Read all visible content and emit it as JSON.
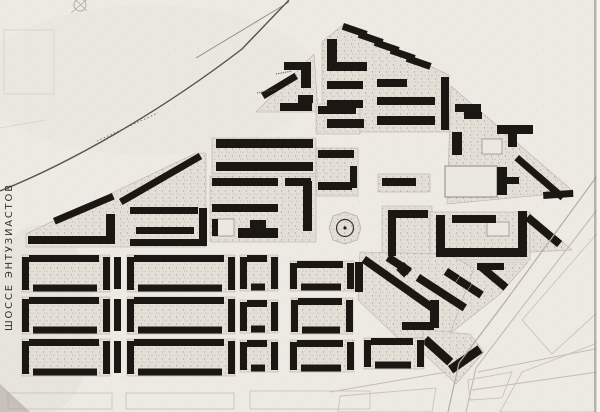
{
  "canvas": {
    "w": 600,
    "h": 412
  },
  "palette": {
    "paper": "#edeae4",
    "ink": "#1b1712",
    "court_stroke": "#b9b3a8",
    "faint": "#c9c3b8",
    "rail": "#46413b",
    "pale_building": "#ebe8e1",
    "label_ink": "#37322b"
  },
  "labels": {
    "left_road": "ШОССЕ  ЭНТУЗИАСТОВ"
  },
  "map": {
    "type": "scanned-urban-plan",
    "features": [
      {
        "t": "ellipse",
        "name": "paper-tone-wash",
        "cx": 150,
        "cy": 80,
        "rx": 170,
        "ry": 75,
        "f": "#e7e3dc",
        "o": 0.55
      },
      {
        "t": "ellipse",
        "name": "paper-tone-wash",
        "cx": 40,
        "cy": 320,
        "rx": 55,
        "ry": 95,
        "f": "#e2ded6",
        "o": 0.5
      },
      {
        "t": "rect",
        "name": "paper-grain-overlay",
        "x": 0,
        "y": 0,
        "w": 600,
        "h": 412,
        "f": "grain",
        "o": 0.6
      },
      {
        "t": "rects",
        "name": "faint-survey-outline",
        "s": "#d7d3ca",
        "items": [
          [
            4,
            30,
            50,
            64
          ]
        ]
      },
      {
        "t": "path",
        "name": "faint-survey-line",
        "d": "M0,128 L46,120",
        "s": "#d7d3ca",
        "w": 0.8
      },
      {
        "t": "path",
        "name": "railway-curve",
        "d": "M0,191 C70,163 160,112 242,49 L289,0",
        "s": "@rail",
        "w": 1.4,
        "o": 0.9
      },
      {
        "t": "path",
        "name": "railway-branch-line",
        "d": "M196,58 L289,2",
        "s": "#6f6961",
        "w": 0.9,
        "o": 0.75
      },
      {
        "t": "path",
        "name": "railway-caption-marks",
        "d": "M97,141 L158,113",
        "s": "#716b62",
        "w": 1.1,
        "o": 0.8,
        "dash": "1.5,2.2"
      },
      {
        "t": "circle",
        "name": "survey-mark-circle",
        "cx": 80,
        "cy": 5,
        "r": 6,
        "s": "#b3ada2",
        "w": 1
      },
      {
        "t": "path",
        "name": "survey-mark-lines",
        "d": "M71,13 L90,-3 M87,11 L74,-2",
        "s": "#b3ada2",
        "w": 0.8
      },
      {
        "t": "poly",
        "name": "block-wedge-courtyard",
        "pts": "26,247 26,234 196,153 206,153 206,247",
        "f": "speckle",
        "s": "@court_stroke",
        "sw": 0.6
      },
      {
        "t": "poly",
        "name": "block-hook-courtyard",
        "pts": "256,112 314,54 318,112",
        "f": "speckle",
        "s": "@court_stroke",
        "sw": 0.6
      },
      {
        "t": "poly",
        "name": "block-pentagon-courtyard",
        "pts": "322,42 344,24 430,66 449,75 449,132 322,132",
        "f": "speckle",
        "s": "@court_stroke",
        "sw": 0.6
      },
      {
        "t": "rect",
        "name": "block-center-north-courtyard",
        "x": 212,
        "y": 138,
        "w": 104,
        "h": 36,
        "f": "speckle",
        "s": "@court_stroke",
        "sw": 0.6
      },
      {
        "t": "rect",
        "name": "block-center-south-courtyard",
        "x": 210,
        "y": 176,
        "w": 106,
        "h": 66,
        "f": "speckle",
        "s": "@court_stroke",
        "sw": 0.6
      },
      {
        "t": "rect",
        "name": "block-midcol-north-courtyard",
        "x": 316,
        "y": 104,
        "w": 44,
        "h": 30,
        "f": "speckle",
        "s": "@court_stroke",
        "sw": 0.6
      },
      {
        "t": "rect",
        "name": "block-midcol-south-courtyard",
        "x": 316,
        "y": 148,
        "w": 42,
        "h": 48,
        "f": "speckle",
        "s": "@court_stroke",
        "sw": 0.6
      },
      {
        "t": "rect",
        "name": "block-east-plaza-north-courtyard",
        "x": 378,
        "y": 174,
        "w": 52,
        "h": 18,
        "f": "speckle",
        "s": "@court_stroke",
        "sw": 0.6
      },
      {
        "t": "rect",
        "name": "block-east-plaza-courtyard",
        "x": 382,
        "y": 206,
        "w": 50,
        "h": 50,
        "f": "speckle",
        "s": "@court_stroke",
        "sw": 0.6
      },
      {
        "t": "poly",
        "name": "block-northeast-triangle-courtyard",
        "pts": "451,86 574,192 447,204",
        "f": "speckle",
        "s": "@court_stroke",
        "sw": 0.6
      },
      {
        "t": "rect",
        "name": "block-east-court-courtyard",
        "x": 430,
        "y": 212,
        "w": 100,
        "h": 48,
        "f": "speckle",
        "s": "@court_stroke",
        "sw": 0.6
      },
      {
        "t": "poly",
        "name": "block-east-court-wing-courtyard",
        "pts": "530,214 572,250 530,252",
        "f": "speckle",
        "s": "@court_stroke",
        "sw": 0.6
      },
      {
        "t": "poly",
        "name": "block-diagonal-rows-courtyard",
        "pts": "416,262 528,262 500,294 452,332 416,324",
        "f": "speckle",
        "s": "@court_stroke",
        "sw": 0.6
      },
      {
        "t": "poly",
        "name": "block-diagonal-wedge-courtyard",
        "pts": "360,252 448,254 474,268 450,334 400,340 358,300",
        "f": "speckle",
        "s": "@court_stroke",
        "sw": 0.6
      },
      {
        "t": "poly",
        "name": "block-chevron-courtyard",
        "pts": "424,330 470,334 484,352 456,384 420,350",
        "f": "speckle",
        "s": "@court_stroke",
        "sw": 0.6
      },
      {
        "t": "poly",
        "name": "plaza-park",
        "pts": "345,212 357,216 361,228 357,240 345,244 333,240 329,228 333,216",
        "f": "speckle",
        "s": "#b0aa9f",
        "sw": 0.7
      },
      {
        "t": "circle",
        "name": "plaza-ring",
        "cx": 345,
        "cy": 228,
        "r": 8.5,
        "s": "#38332d",
        "w": 1.2
      },
      {
        "t": "circle",
        "name": "plaza-center-dot",
        "cx": 345,
        "cy": 228,
        "r": 1.6,
        "f": "#241f1a"
      },
      {
        "t": "rect",
        "name": "pale-hall-building",
        "x": 445,
        "y": 166,
        "w": 52,
        "h": 31,
        "f": "@pale_building",
        "s": "#8f897e",
        "sw": 1
      },
      {
        "t": "rect",
        "name": "pale-building",
        "x": 482,
        "y": 139,
        "w": 20,
        "h": 15,
        "f": "@pale_building",
        "s": "#9a948a",
        "sw": 0.8
      },
      {
        "t": "rect",
        "name": "pale-building",
        "x": 487,
        "y": 222,
        "w": 22,
        "h": 14,
        "f": "@pale_building",
        "s": "#9a948a",
        "sw": 0.8
      },
      {
        "t": "rect",
        "name": "pale-building",
        "x": 214,
        "y": 219,
        "w": 20,
        "h": 17,
        "f": "@pale_building",
        "s": "#9a948a",
        "sw": 0.8
      },
      {
        "t": "bars",
        "name": "wedge-building",
        "items": [
          [
            53,
            218,
            64,
            7,
            -23
          ],
          [
            119,
            199,
            92,
            7,
            -30
          ],
          [
            28,
            236,
            86,
            8
          ],
          [
            106,
            214,
            9,
            30
          ],
          [
            130,
            207,
            68,
            7
          ],
          [
            136,
            227,
            58,
            7
          ],
          [
            130,
            239,
            74,
            7
          ],
          [
            199,
            208,
            8,
            38
          ]
        ]
      },
      {
        "t": "bars",
        "name": "hook-building",
        "items": [
          [
            261,
            93,
            39,
            7,
            -31
          ],
          [
            284,
            62,
            26,
            8
          ],
          [
            301,
            62,
            10,
            26
          ],
          [
            298,
            95,
            15,
            8
          ],
          [
            280,
            103,
            32,
            8
          ]
        ]
      },
      {
        "t": "path",
        "name": "tiny-annotation-marks",
        "d": "M276,74 L292,71 M257,93 L277,89",
        "s": "#4e4943",
        "w": 1.1,
        "dash": "1.2,1.1",
        "o": 0.9
      },
      {
        "t": "bars",
        "name": "pentagon-building",
        "items": [
          [
            344,
            23,
            25,
            7,
            19
          ],
          [
            360,
            31,
            25,
            7,
            19
          ],
          [
            376,
            39,
            25,
            7,
            19
          ],
          [
            392,
            47,
            25,
            7,
            19
          ],
          [
            408,
            55,
            25,
            7,
            19
          ],
          [
            327,
            39,
            10,
            29
          ],
          [
            327,
            62,
            40,
            9
          ],
          [
            327,
            81,
            36,
            8
          ],
          [
            377,
            79,
            30,
            8
          ],
          [
            327,
            100,
            36,
            8
          ],
          [
            377,
            97,
            58,
            8
          ],
          [
            327,
            119,
            37,
            9
          ],
          [
            377,
            116,
            58,
            9
          ],
          [
            441,
            77,
            8,
            53
          ]
        ]
      },
      {
        "t": "bars",
        "name": "center-north-building",
        "items": [
          [
            216,
            139,
            97,
            9
          ],
          [
            216,
            162,
            97,
            9
          ]
        ]
      },
      {
        "t": "bars",
        "name": "center-south-building",
        "items": [
          [
            212,
            178,
            66,
            8
          ],
          [
            212,
            204,
            66,
            8
          ],
          [
            285,
            178,
            26,
            8
          ],
          [
            303,
            181,
            9,
            50
          ],
          [
            238,
            228,
            40,
            10
          ],
          [
            250,
            220,
            16,
            9
          ],
          [
            212,
            219,
            6,
            17
          ]
        ]
      },
      {
        "t": "bars",
        "name": "midcol-building",
        "items": [
          [
            318,
            106,
            38,
            8
          ],
          [
            318,
            150,
            36,
            8
          ],
          [
            318,
            182,
            34,
            8
          ],
          [
            350,
            166,
            7,
            22
          ]
        ]
      },
      {
        "t": "bars",
        "name": "east-plaza-building",
        "items": [
          [
            382,
            178,
            34,
            8
          ],
          [
            388,
            210,
            8,
            46
          ],
          [
            388,
            210,
            40,
            8
          ],
          [
            390,
            254,
            26,
            8,
            33
          ],
          [
            404,
            262,
            11,
            11,
            45
          ]
        ]
      },
      {
        "t": "bars",
        "name": "triangle-building",
        "items": [
          [
            455,
            104,
            26,
            8
          ],
          [
            464,
            112,
            18,
            7
          ],
          [
            452,
            132,
            10,
            23
          ],
          [
            497,
            125,
            36,
            9
          ],
          [
            508,
            134,
            9,
            13
          ],
          [
            497,
            167,
            10,
            28
          ],
          [
            506,
            177,
            13,
            7
          ],
          [
            519,
            155,
            32,
            7,
            41
          ],
          [
            541,
            174,
            32,
            7,
            41
          ],
          [
            543,
            192,
            30,
            7,
            -4
          ]
        ]
      },
      {
        "t": "bars",
        "name": "east-court-building",
        "items": [
          [
            436,
            215,
            9,
            42
          ],
          [
            436,
            248,
            90,
            9
          ],
          [
            518,
            211,
            9,
            46
          ],
          [
            452,
            215,
            44,
            8
          ],
          [
            530,
            214,
            42,
            8,
            40
          ]
        ]
      },
      {
        "t": "bars",
        "name": "diagonal-row-building",
        "items": [
          [
            420,
            274,
            56,
            8,
            33
          ],
          [
            448,
            268,
            14,
            8,
            33
          ],
          [
            460,
            276,
            14,
            8,
            33
          ],
          [
            472,
            284,
            14,
            8,
            33
          ],
          [
            477,
            263,
            27,
            7
          ],
          [
            484,
            264,
            32,
            8,
            40
          ]
        ]
      },
      {
        "t": "bars",
        "name": "diagonal-wedge-building",
        "items": [
          [
            355,
            262,
            8,
            30
          ],
          [
            366,
            256,
            30,
            8,
            35
          ],
          [
            390,
            273,
            30,
            8,
            35
          ],
          [
            414,
            290,
            30,
            8,
            35
          ],
          [
            430,
            300,
            9,
            28
          ],
          [
            402,
            322,
            32,
            8
          ],
          [
            428,
            336,
            34,
            9,
            42
          ],
          [
            448,
            366,
            36,
            9,
            -35
          ]
        ]
      },
      {
        "t": "cells",
        "name": "residential-block",
        "items": [
          [
            22,
            255,
            88,
            37
          ],
          [
            127,
            255,
            108,
            37
          ],
          [
            240,
            255,
            38,
            36
          ],
          [
            290,
            261,
            64,
            30
          ],
          [
            22,
            297,
            88,
            37
          ],
          [
            127,
            297,
            108,
            37
          ],
          [
            240,
            300,
            38,
            33
          ],
          [
            291,
            298,
            62,
            36
          ],
          [
            22,
            339,
            88,
            37
          ],
          [
            127,
            339,
            108,
            37
          ],
          [
            240,
            340,
            38,
            32
          ],
          [
            290,
            340,
            64,
            32
          ],
          [
            364,
            338,
            60,
            31
          ]
        ]
      },
      {
        "t": "bars",
        "name": "inter-block-building",
        "items": [
          [
            114,
            257,
            7,
            32
          ],
          [
            114,
            299,
            7,
            32
          ],
          [
            114,
            341,
            7,
            32
          ]
        ]
      },
      {
        "t": "path",
        "name": "avenue-edge-line",
        "d": "M597,176 L505,302 L459,363 L448,412",
        "s": "#b4aea3",
        "w": 1.2
      },
      {
        "t": "path",
        "name": "avenue-edge-line",
        "d": "M600,206 L520,310 L476,368 L466,412",
        "s": "#bdb7ac",
        "w": 1
      },
      {
        "t": "path",
        "name": "radial-road-line",
        "d": "M478,372 L600,348 M472,390 L598,372 M447,372 L330,392",
        "s": "#c3bdb2",
        "w": 1
      },
      {
        "t": "polys",
        "name": "planned-block-outline",
        "s": "@faint",
        "w": 0.9,
        "items": [
          "522,320 600,230 600,310 552,354",
          "500,412 522,372 600,342 600,412",
          "340,396 436,388 432,412 338,412",
          "468,380 512,372 502,398 470,400"
        ]
      },
      {
        "t": "rects",
        "name": "planned-block-outline",
        "s": "#ccc6bb",
        "items": [
          [
            8,
            393,
            104,
            16
          ],
          [
            126,
            393,
            108,
            16
          ],
          [
            250,
            391,
            120,
            18
          ]
        ]
      },
      {
        "t": "poly",
        "name": "corner-shadow",
        "pts": "0,384 30,412 0,412",
        "f": "#a39c8f",
        "o": 0.5
      },
      {
        "t": "rect",
        "name": "scan-edge-line",
        "x": 594,
        "y": 0,
        "w": 2.5,
        "h": 412,
        "f": "#8d867b",
        "o": 0.55
      },
      {
        "t": "rect",
        "name": "scan-edge-white",
        "x": 596.5,
        "y": 0,
        "w": 3.5,
        "h": 412,
        "f": "#f6f4f0",
        "o": 1
      },
      {
        "t": "text",
        "name": "shosse-entuziastov-label",
        "label": "left_road",
        "x": 12,
        "y": 331,
        "size": 10,
        "rot": -90,
        "ls": 1.8,
        "fill": "@label_ink"
      }
    ]
  }
}
